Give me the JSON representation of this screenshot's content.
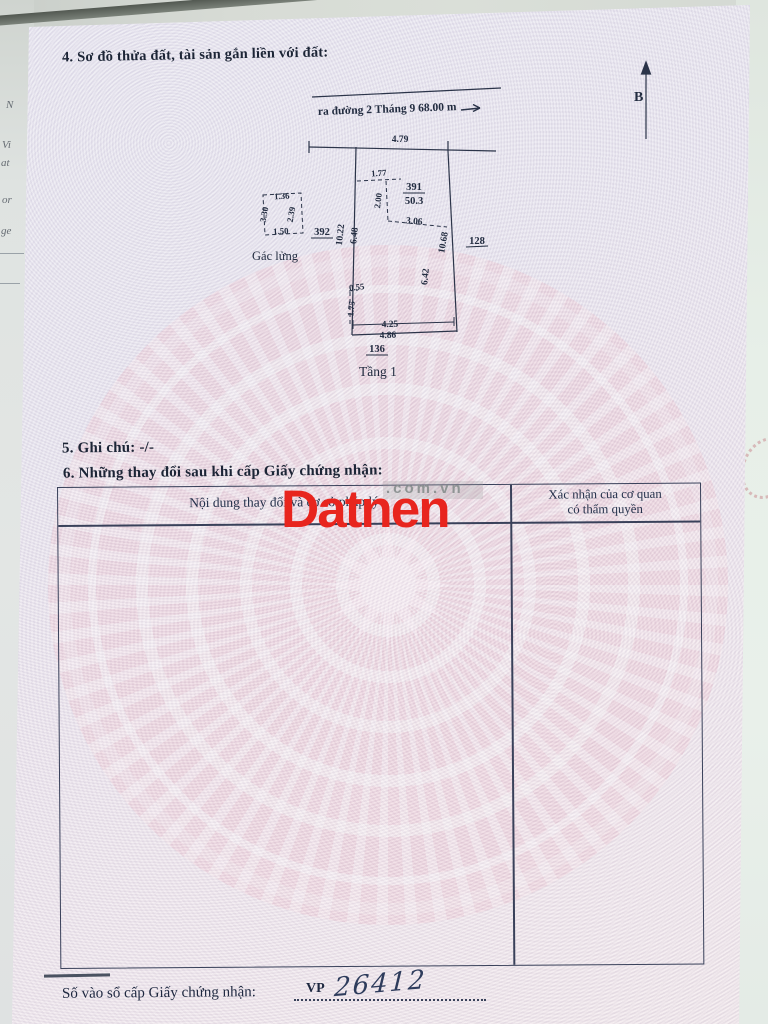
{
  "document": {
    "section4_title": "4. Sơ đồ thửa đất, tài sản gắn liền với đất:",
    "section5_title": "5. Ghi chú: -/-",
    "section6_title": "6. Những thay đổi sau khi cấp Giấy chứng nhận:",
    "register_label": "Số vào sổ cấp Giấy chứng nhận:",
    "register_prefix": "VP",
    "register_number": "26412"
  },
  "diagram": {
    "road_label": "ra đường 2 Tháng 9  68.00 m",
    "north_label": "B",
    "parcel": {
      "number": "391",
      "area": "50.3"
    },
    "neighbors": {
      "left": "392",
      "right": "128",
      "bottom": "136"
    },
    "mezzanine_label": "Gác lửng",
    "floor_label": "Tầng 1",
    "dims": {
      "frontage": "4.79",
      "inner_top": "1.77",
      "inner_left": "2.00",
      "inner_mid": "3.06",
      "left_outer": "10.22",
      "left_inner": "6.48",
      "right_outer": "10.68",
      "right_inner": "6.42",
      "notch_w": "0.55",
      "notch_h": "1.75",
      "bottom_inner": "4.25",
      "bottom_outer": "4.86",
      "box_top": "1.36",
      "box_left": "3.30",
      "box_right": "2.39",
      "box_bottom": "1.50"
    }
  },
  "table": {
    "col1_header": "Nội dung thay đổi và cơ sở pháp lý",
    "col2_header_line1": "Xác nhận của cơ quan",
    "col2_header_line2": "có thẩm quyền"
  },
  "watermark": {
    "brand": "Datnen",
    "domain": ".com.vn",
    "brand_color": "#e8251e"
  },
  "underlay_fragments": [
    "N",
    "Vi",
    "at",
    "or",
    "ge"
  ]
}
